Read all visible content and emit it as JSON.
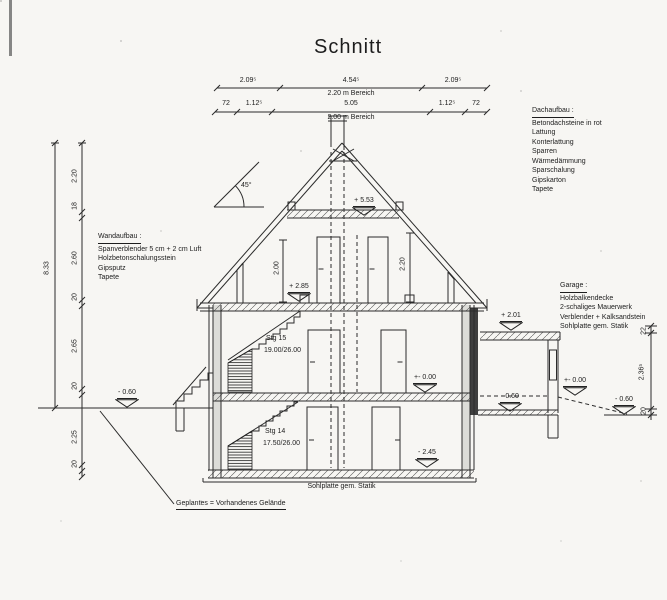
{
  "title": "Schnitt",
  "top_dims": {
    "row1": {
      "a": "2.09⁵",
      "b": "4.54⁵",
      "c": "2.09⁵",
      "note": "2.20 m Bereich"
    },
    "row2": {
      "a": "72",
      "b": "1.12⁵",
      "c": "5.05",
      "d": "1.12⁵",
      "e": "72",
      "note": "2.00 m Bereich"
    }
  },
  "left_dims": {
    "total": "8.33",
    "s": [
      "2.20",
      "18",
      "2.60",
      "20",
      "2.65",
      "20",
      "2.25",
      "20"
    ]
  },
  "right_dims": {
    "s": [
      "22",
      "2.36⁵",
      "20"
    ]
  },
  "attic_dims": {
    "left": "2.00",
    "right": "2.20"
  },
  "roof": {
    "angle": "45°"
  },
  "levels": {
    "collar": "+ 5.53",
    "attic": "+ 2.85",
    "eg": "+- 0.00",
    "terrain_left": "- 0.60",
    "kg": "- 2.45",
    "garage_roof": "+ 2.01",
    "garage_floor": "- 0.60",
    "garage_eg": "+- 0.00",
    "terrain_right": "- 0.60"
  },
  "stairs": {
    "upper": {
      "name": "Stg  15",
      "ratio": "19.00/26.00"
    },
    "lower": {
      "name": "Stg  14",
      "ratio": "17.50/26.00"
    }
  },
  "notes": {
    "dach": {
      "heading": "Dachaufbau :",
      "lines": [
        "Betondachsteine in rot",
        "Lattung",
        "Konterlattung",
        "Sparren",
        "Wärmedämmung",
        "Sparschalung",
        "Gipskarton",
        "Tapete"
      ]
    },
    "wand": {
      "heading": "Wandaufbau :",
      "lines": [
        "Spanverblender 5 cm + 2 cm Luft",
        "Holzbetonschalungsstein",
        "Gipsputz",
        "Tapete"
      ]
    },
    "garage": {
      "heading": "Garage :",
      "lines": [
        "Holzbalkendecke",
        "2-schaliges Mauerwerk",
        "Verblender + Kalksandstein",
        "Sohlplatte gem. Statik"
      ]
    }
  },
  "footer": {
    "slab": "Sohlplatte gem. Statik",
    "legend": "Geplantes = Vorhandenes Gelände"
  }
}
